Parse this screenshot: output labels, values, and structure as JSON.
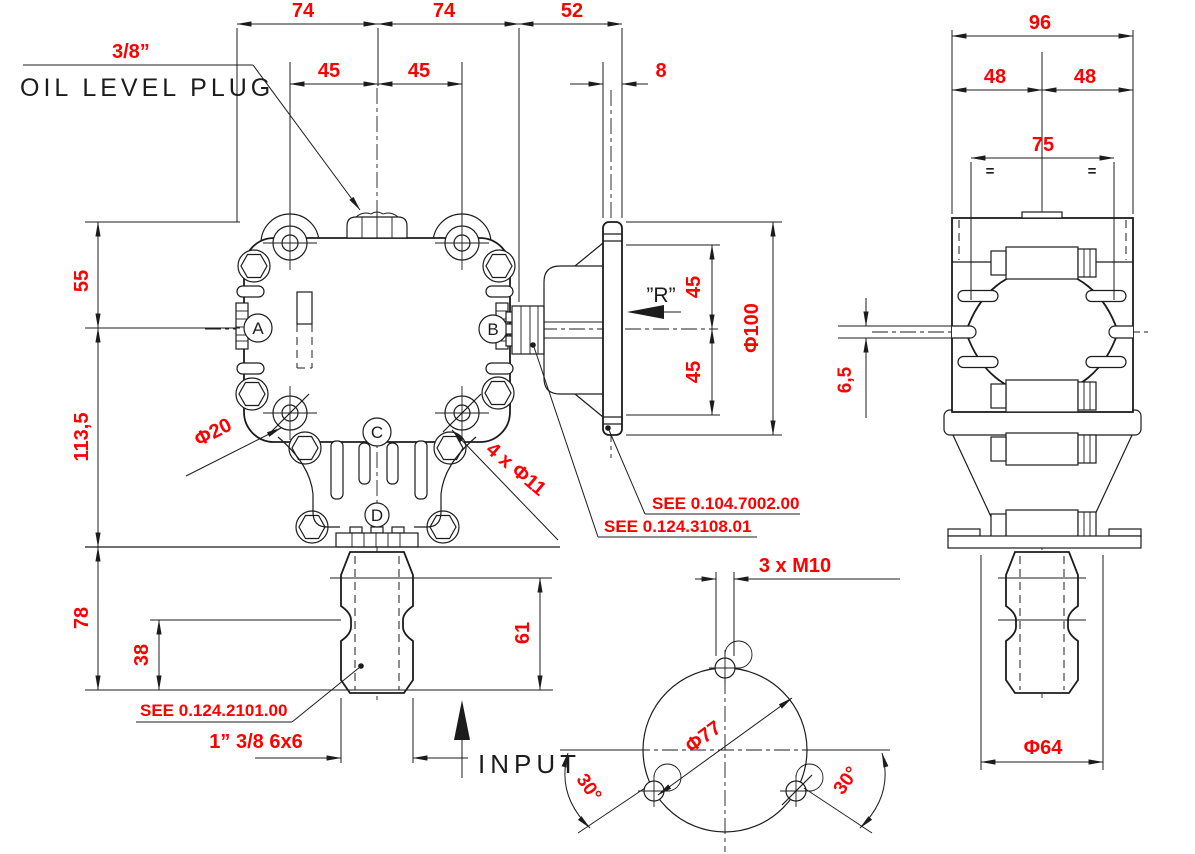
{
  "title": "Gearbox dimensional drawing",
  "colors": {
    "dimension_text": "#ff0000",
    "linework": "#1c1c1c",
    "background": "#ffffff"
  },
  "callouts": {
    "plug_size": "3/8”",
    "plug_label": "OIL LEVEL PLUG",
    "see_7002": "SEE 0.104.7002.00",
    "see_3108": "SEE 0.124.3108.01",
    "see_2101": "SEE 0.124.2101.00",
    "input_label": "INPUT",
    "r_mark": "”R”"
  },
  "front": {
    "d74l": "74",
    "d74r": "74",
    "d52": "52",
    "d45l": "45",
    "d45r": "45",
    "d8": "8",
    "d55": "55",
    "d113": "113,5",
    "d78": "78",
    "d38": "38",
    "d61": "61",
    "phi20": "Φ20",
    "phi11": "4 x Φ11",
    "d45u": "45",
    "d45d": "45",
    "phi100": "Φ100",
    "spline": "1” 3/8 6x6",
    "port_a": "A",
    "port_b": "B",
    "port_c": "C",
    "port_d": "D"
  },
  "side": {
    "d96": "96",
    "d48l": "48",
    "d48r": "48",
    "d75": "75",
    "eq": "=",
    "d65": "6,5",
    "phi64": "Φ64"
  },
  "bottom": {
    "m10": "3 x M10",
    "phi77": "Φ77",
    "a30l": "30°",
    "a30r": "30°"
  }
}
